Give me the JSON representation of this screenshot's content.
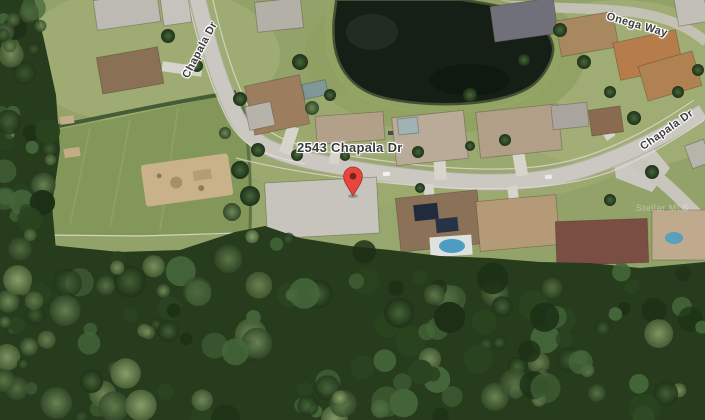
{
  "labels": {
    "address_marker": "2543 Chapala Dr",
    "street_left": "Chapala Dr",
    "street_right": "Chapala Dr",
    "street_top": "Onega Way",
    "watermark": "Stellar MLS"
  },
  "marker": {
    "label": "2543 Chapala Dr",
    "color": "#E8453C",
    "dot_color": "#7e241c"
  },
  "palette": {
    "forest": "#273c1d",
    "grass": "#93a269",
    "road": "#cbc8c1",
    "water": "#161f15"
  }
}
